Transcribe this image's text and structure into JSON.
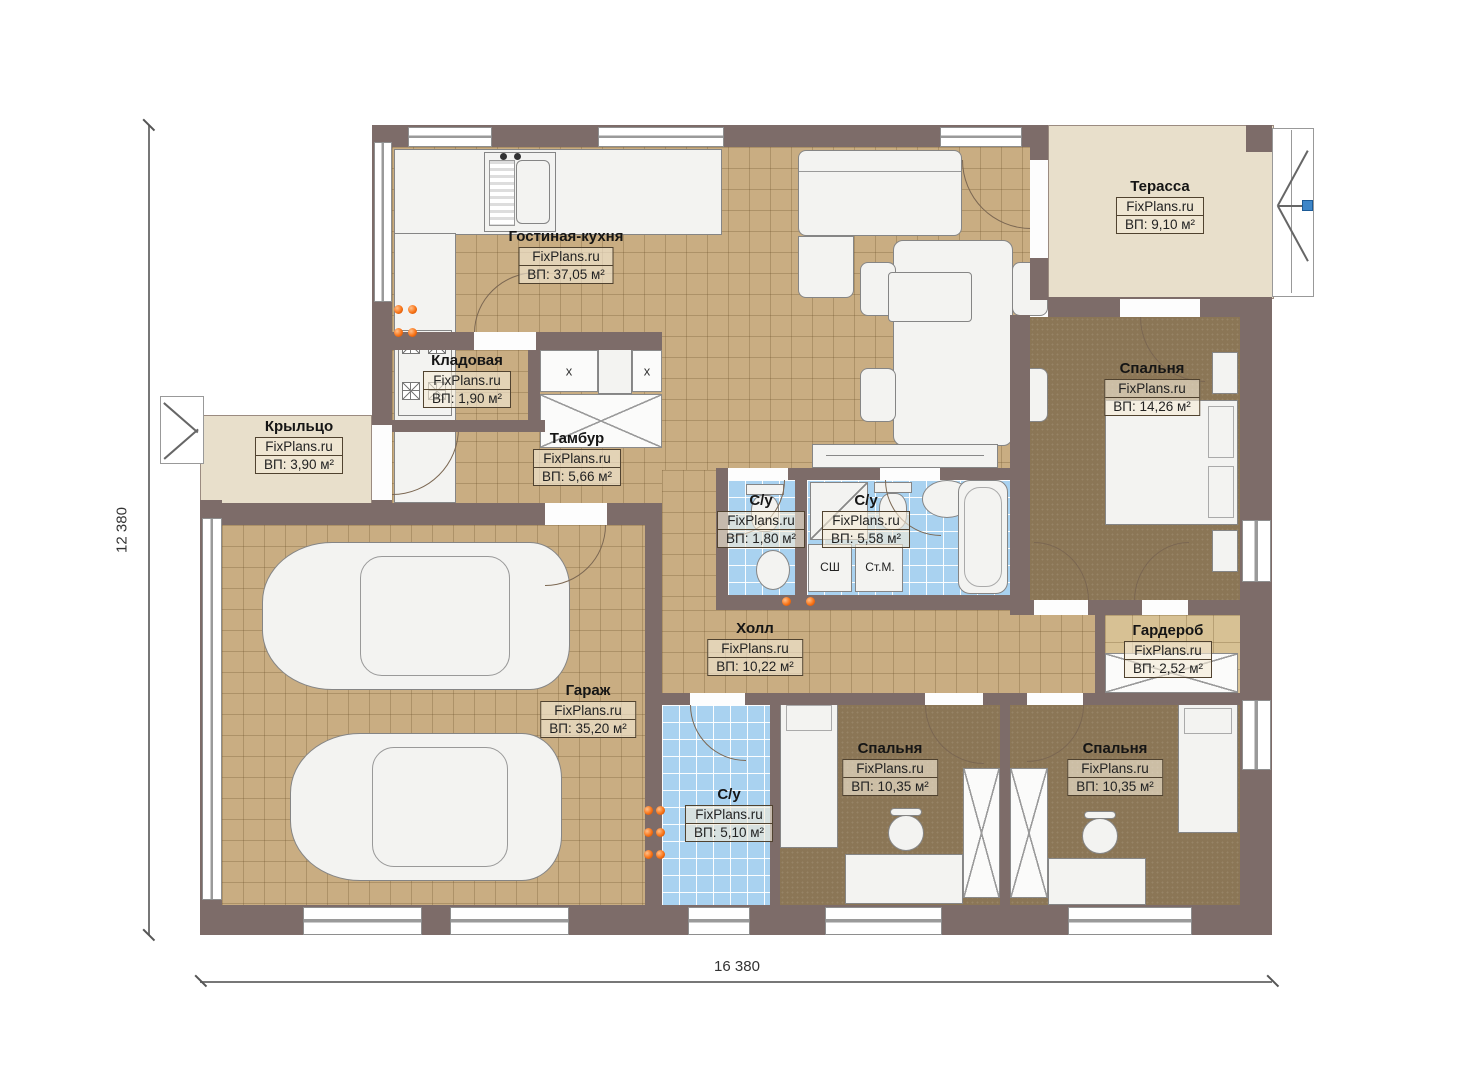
{
  "brand": "FixPlans.ru",
  "dimensions": {
    "width_label": "16 380",
    "height_label": "12 380"
  },
  "rooms": {
    "living": {
      "name": "Гостиная-кухня",
      "area": "ВП: 37,05 м²"
    },
    "terrace": {
      "name": "Терасса",
      "area": "ВП: 9,10 м²"
    },
    "storage": {
      "name": "Кладовая",
      "area": "ВП: 1,90 м²"
    },
    "porch": {
      "name": "Крыльцо",
      "area": "ВП: 3,90 м²"
    },
    "vestibule": {
      "name": "Тамбур",
      "area": "ВП: 5,66 м²"
    },
    "wc_small": {
      "name": "С/у",
      "area": "ВП: 1,80 м²"
    },
    "wc_big": {
      "name": "С/у",
      "area": "ВП: 5,58 м²"
    },
    "bedroom_master": {
      "name": "Спальня",
      "area": "ВП: 14,26 м²"
    },
    "hall": {
      "name": "Холл",
      "area": "ВП: 10,22 м²"
    },
    "wardrobe": {
      "name": "Гардероб",
      "area": "ВП: 2,52 м²"
    },
    "garage": {
      "name": "Гараж",
      "area": "ВП: 35,20 м²"
    },
    "wc_bottom": {
      "name": "С/у",
      "area": "ВП: 5,10 м²"
    },
    "bedroom_1": {
      "name": "Спальня",
      "area": "ВП: 10,35 м²"
    },
    "bedroom_2": {
      "name": "Спальня",
      "area": "ВП: 10,35 м²"
    }
  },
  "annotations": {
    "closet_mark": "x",
    "dryer": "СШ",
    "washer": "Ст.М."
  },
  "colors": {
    "wall": "#7d6c69",
    "tile": "#c9ad82",
    "carpet": "#8b7656",
    "bath": "#a9d2f0",
    "terrace": "#e8dfcb",
    "accent_dot": "#f97316",
    "handle": "#3e86c8"
  }
}
